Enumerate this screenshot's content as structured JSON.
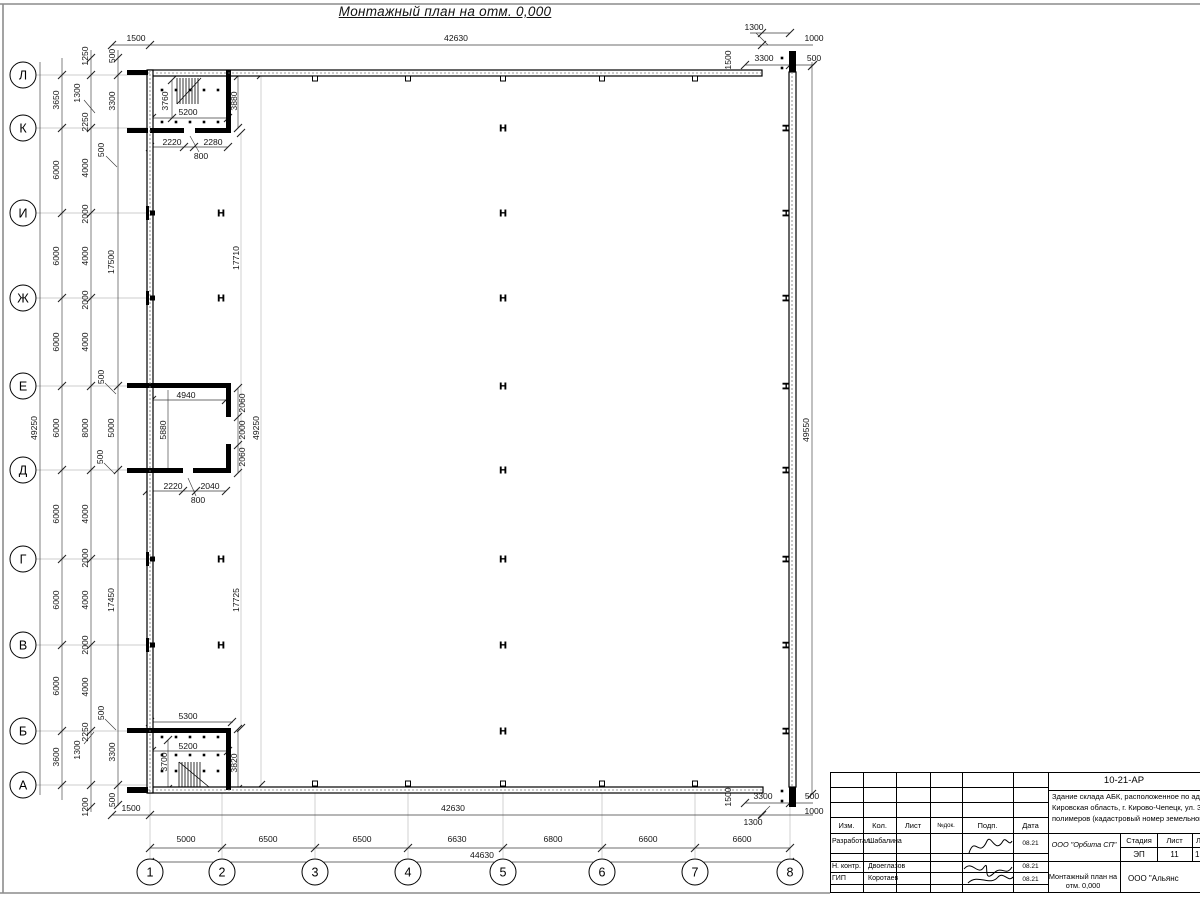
{
  "sheet": {
    "title": "Монтажный план на отм. 0,000"
  },
  "axes": {
    "rows": [
      {
        "l": "Л",
        "y": 75
      },
      {
        "l": "К",
        "y": 128
      },
      {
        "l": "И",
        "y": 213
      },
      {
        "l": "Ж",
        "y": 298
      },
      {
        "l": "Е",
        "y": 386
      },
      {
        "l": "Д",
        "y": 470
      },
      {
        "l": "Г",
        "y": 559
      },
      {
        "l": "В",
        "y": 645
      },
      {
        "l": "Б",
        "y": 731
      },
      {
        "l": "А",
        "y": 785
      }
    ],
    "cols": [
      {
        "l": "1",
        "x": 150
      },
      {
        "l": "2",
        "x": 222
      },
      {
        "l": "3",
        "x": 315
      },
      {
        "l": "4",
        "x": 408
      },
      {
        "l": "5",
        "x": 503
      },
      {
        "l": "6",
        "x": 602
      },
      {
        "l": "7",
        "x": 695
      },
      {
        "l": "8",
        "x": 790
      }
    ]
  },
  "title_block": {
    "doc_code": "10-21-АР",
    "desc1": "Здание склада АБК, расположенное по адресу: Российская Феде",
    "desc2": "Кировская область, г. Кирово-Чепецк, ул. Заводская, площадка з",
    "desc3": "полимеров (кадастровый номер земельного участка 43:42:0000",
    "header": {
      "izm": "Изм.",
      "kol": "Кол.",
      "list": "Лист",
      "ndok": "№док.",
      "podp": "Подп.",
      "data": "Дата"
    },
    "rows": {
      "r1": {
        "role": "Разработал",
        "name": "Шабалина",
        "date": "08.21"
      },
      "r2": {
        "role": "Н. контр.",
        "name": "Двоеглазов",
        "date": "08.21"
      },
      "r3": {
        "role": "ГИП",
        "name": "Коротаев",
        "date": "08.21"
      }
    },
    "org": "ООО \"Орбита СП\"",
    "stage_h": "Стадия",
    "sheet_h": "Лист",
    "sheets_h": "Листов",
    "stage": "ЭП",
    "sheet_no": "11",
    "sheets": "1",
    "drawing_name": "Монтажный план на отм. 0,000",
    "company": "ООО \"Альянс"
  },
  "drawing": {
    "frame": [
      [
        0,
        4,
        1200,
        4
      ],
      [
        0,
        893,
        830,
        893
      ],
      [
        3,
        4,
        3,
        893
      ]
    ],
    "lines_gray": [
      [
        36,
        75,
        147,
        75
      ],
      [
        36,
        128,
        147,
        128
      ],
      [
        36,
        213,
        147,
        213
      ],
      [
        36,
        298,
        147,
        298
      ],
      [
        36,
        386,
        147,
        386
      ],
      [
        36,
        470,
        147,
        470
      ],
      [
        36,
        559,
        147,
        559
      ],
      [
        36,
        645,
        147,
        645
      ],
      [
        36,
        731,
        147,
        731
      ],
      [
        36,
        785,
        147,
        785
      ],
      [
        150,
        793,
        150,
        858
      ],
      [
        222,
        793,
        222,
        858
      ],
      [
        315,
        793,
        315,
        858
      ],
      [
        408,
        793,
        408,
        858
      ],
      [
        503,
        793,
        503,
        858
      ],
      [
        602,
        793,
        602,
        858
      ],
      [
        695,
        793,
        695,
        858
      ],
      [
        790,
        793,
        790,
        858
      ],
      [
        241,
        133,
        241,
        728
      ],
      [
        261,
        75,
        261,
        785
      ]
    ],
    "lines_dim": [
      [
        40,
        62,
        40,
        795
      ],
      [
        62,
        58,
        62,
        800
      ],
      [
        91,
        50,
        91,
        812
      ],
      [
        118,
        50,
        118,
        806
      ],
      [
        812,
        62,
        812,
        795
      ],
      [
        112,
        45,
        813,
        45
      ],
      [
        745,
        65,
        813,
        65
      ],
      [
        750,
        33,
        790,
        33
      ],
      [
        112,
        815,
        813,
        815
      ],
      [
        150,
        848,
        790,
        848
      ],
      [
        150,
        862,
        790,
        862
      ],
      [
        745,
        803,
        813,
        803
      ],
      [
        152,
        118,
        228,
        118
      ],
      [
        172,
        80,
        172,
        118
      ],
      [
        238,
        76,
        238,
        128
      ],
      [
        150,
        147,
        228,
        147
      ],
      [
        152,
        400,
        226,
        400
      ],
      [
        168,
        390,
        168,
        468
      ],
      [
        238,
        388,
        238,
        473
      ],
      [
        147,
        491,
        226,
        491
      ],
      [
        150,
        722,
        233,
        722
      ],
      [
        152,
        751,
        228,
        751
      ],
      [
        168,
        740,
        168,
        789
      ],
      [
        238,
        729,
        238,
        789
      ],
      [
        756,
        33,
        768,
        45
      ],
      [
        84,
        100,
        95,
        113
      ],
      [
        84,
        744,
        94,
        732
      ],
      [
        106,
        156,
        117,
        167
      ],
      [
        105,
        383,
        116,
        394
      ],
      [
        104,
        463,
        115,
        474
      ],
      [
        105,
        719,
        116,
        730
      ],
      [
        190,
        136,
        199,
        152
      ],
      [
        188,
        478,
        196,
        496
      ],
      [
        758,
        818,
        770,
        806
      ]
    ],
    "ticks": [
      [
        150,
        848
      ],
      [
        222,
        848
      ],
      [
        315,
        848
      ],
      [
        408,
        848
      ],
      [
        503,
        848
      ],
      [
        602,
        848
      ],
      [
        695,
        848
      ],
      [
        790,
        848
      ],
      [
        62,
        75
      ],
      [
        62,
        128
      ],
      [
        62,
        213
      ],
      [
        62,
        298
      ],
      [
        62,
        386
      ],
      [
        62,
        470
      ],
      [
        62,
        559
      ],
      [
        62,
        645
      ],
      [
        62,
        731
      ],
      [
        62,
        785
      ],
      [
        91,
        58
      ],
      [
        91,
        75
      ],
      [
        91,
        128
      ],
      [
        91,
        213
      ],
      [
        91,
        298
      ],
      [
        91,
        386
      ],
      [
        91,
        470
      ],
      [
        91,
        559
      ],
      [
        91,
        645
      ],
      [
        91,
        731
      ],
      [
        91,
        785
      ],
      [
        91,
        807
      ],
      [
        118,
        58
      ],
      [
        118,
        75
      ],
      [
        118,
        386
      ],
      [
        118,
        470
      ],
      [
        118,
        785
      ],
      [
        118,
        805
      ],
      [
        112,
        45
      ],
      [
        150,
        45
      ],
      [
        762,
        45
      ],
      [
        762,
        33
      ],
      [
        790,
        33
      ],
      [
        745,
        65
      ],
      [
        790,
        65
      ],
      [
        813,
        65
      ],
      [
        112,
        815
      ],
      [
        150,
        815
      ],
      [
        762,
        815
      ],
      [
        745,
        803
      ],
      [
        790,
        803
      ],
      [
        150,
        862
      ],
      [
        790,
        862
      ],
      [
        812,
        66
      ],
      [
        812,
        794
      ],
      [
        261,
        75
      ],
      [
        261,
        785
      ],
      [
        241,
        133
      ],
      [
        241,
        728
      ],
      [
        150,
        147
      ],
      [
        184,
        147
      ],
      [
        194,
        147
      ],
      [
        228,
        147
      ],
      [
        152,
        118
      ],
      [
        228,
        118
      ],
      [
        172,
        80
      ],
      [
        172,
        118
      ],
      [
        238,
        76
      ],
      [
        238,
        128
      ],
      [
        152,
        400
      ],
      [
        226,
        400
      ],
      [
        147,
        491
      ],
      [
        183,
        491
      ],
      [
        196,
        491
      ],
      [
        226,
        491
      ],
      [
        238,
        388
      ],
      [
        238,
        417
      ],
      [
        238,
        445
      ],
      [
        238,
        473
      ],
      [
        150,
        722
      ],
      [
        232,
        722
      ],
      [
        152,
        751
      ],
      [
        228,
        751
      ],
      [
        168,
        740
      ],
      [
        168,
        789
      ],
      [
        238,
        729
      ],
      [
        238,
        789
      ]
    ],
    "walls_outline": [
      [
        148,
        70,
        614,
        6
      ],
      [
        148,
        787,
        615,
        6
      ],
      [
        147,
        70,
        6,
        723
      ],
      [
        789,
        72,
        7,
        715
      ]
    ],
    "wall_mid_dash": [
      [
        148,
        73,
        762,
        73
      ],
      [
        148,
        790,
        763,
        790
      ],
      [
        150,
        70,
        150,
        793
      ],
      [
        792,
        72,
        792,
        787
      ]
    ],
    "walls_solid": [
      [
        127,
        70,
        21,
        5
      ],
      [
        127,
        128,
        21,
        5
      ],
      [
        127,
        383,
        21,
        5
      ],
      [
        127,
        468,
        21,
        5
      ],
      [
        127,
        728,
        21,
        5
      ],
      [
        127,
        787,
        21,
        6
      ],
      [
        226,
        70,
        5,
        63
      ],
      [
        150,
        128,
        34,
        5
      ],
      [
        195,
        128,
        33,
        5
      ],
      [
        148,
        383,
        83,
        5
      ],
      [
        226,
        388,
        5,
        29
      ],
      [
        226,
        444,
        5,
        29
      ],
      [
        147,
        468,
        36,
        5
      ],
      [
        193,
        468,
        38,
        5
      ],
      [
        147,
        728,
        84,
        5
      ],
      [
        226,
        728,
        5,
        62
      ],
      [
        789,
        51,
        7,
        21
      ],
      [
        789,
        787,
        7,
        20
      ]
    ],
    "tabs": {
      "top_y": 76,
      "bot_y": 781,
      "xs": [
        315,
        408,
        503,
        602,
        695
      ]
    },
    "hcols_plain": [
      [
        503,
        [
          128,
          213,
          298,
          386,
          470,
          559,
          645,
          731
        ]
      ],
      [
        221,
        [
          213,
          298,
          559,
          645
        ]
      ]
    ],
    "hcols_rot": {
      "x": 786,
      "ys": [
        128,
        213,
        298,
        386,
        470,
        559,
        645,
        731
      ]
    },
    "pilasters": [
      213,
      298,
      559,
      645
    ],
    "dots": [
      [
        162,
        90
      ],
      [
        176,
        90
      ],
      [
        190,
        90
      ],
      [
        204,
        90
      ],
      [
        218,
        90
      ],
      [
        162,
        122
      ],
      [
        176,
        122
      ],
      [
        190,
        122
      ],
      [
        204,
        122
      ],
      [
        218,
        122
      ],
      [
        162,
        737
      ],
      [
        176,
        737
      ],
      [
        190,
        737
      ],
      [
        204,
        737
      ],
      [
        218,
        737
      ],
      [
        162,
        755
      ],
      [
        176,
        755
      ],
      [
        190,
        755
      ],
      [
        204,
        755
      ],
      [
        218,
        755
      ],
      [
        162,
        771
      ],
      [
        176,
        771
      ],
      [
        204,
        771
      ],
      [
        218,
        771
      ],
      [
        782,
        58
      ],
      [
        782,
        68
      ],
      [
        782,
        791
      ],
      [
        782,
        801
      ]
    ],
    "stairs": [
      {
        "x": 177,
        "y": 78,
        "h": 26,
        "n": 8,
        "dir": 1
      },
      {
        "x": 179,
        "y": 762,
        "h": 25,
        "n": 8,
        "dir": 0
      }
    ],
    "labels": [
      [
        "1500",
        136,
        38,
        0
      ],
      [
        "42630",
        456,
        38,
        0
      ],
      [
        "1300",
        754,
        27,
        0
      ],
      [
        "1000",
        814,
        38,
        0
      ],
      [
        "3300",
        764,
        58,
        0
      ],
      [
        "500",
        814,
        58,
        0
      ],
      [
        "1500",
        728,
        60,
        1
      ],
      [
        "49250",
        34,
        428,
        1
      ],
      [
        "3650",
        56,
        100,
        1
      ],
      [
        "6000",
        56,
        170,
        1
      ],
      [
        "6000",
        56,
        256,
        1
      ],
      [
        "6000",
        56,
        342,
        1
      ],
      [
        "6000",
        56,
        428,
        1
      ],
      [
        "6000",
        56,
        514,
        1
      ],
      [
        "6000",
        56,
        600,
        1
      ],
      [
        "6000",
        56,
        686,
        1
      ],
      [
        "3600",
        56,
        757,
        1
      ],
      [
        "1250",
        85,
        56,
        1
      ],
      [
        "2250",
        85,
        122,
        1
      ],
      [
        "4000",
        85,
        168,
        1
      ],
      [
        "2000",
        85,
        214,
        1
      ],
      [
        "4000",
        85,
        256,
        1
      ],
      [
        "2000",
        85,
        300,
        1
      ],
      [
        "4000",
        85,
        342,
        1
      ],
      [
        "8000",
        85,
        428,
        1
      ],
      [
        "4000",
        85,
        514,
        1
      ],
      [
        "2000",
        85,
        558,
        1
      ],
      [
        "4000",
        85,
        600,
        1
      ],
      [
        "2000",
        85,
        645,
        1
      ],
      [
        "4000",
        85,
        687,
        1
      ],
      [
        "2250",
        85,
        732,
        1
      ],
      [
        "1200",
        85,
        807,
        1
      ],
      [
        "1300",
        77,
        93,
        1
      ],
      [
        "1300",
        77,
        750,
        1
      ],
      [
        "500",
        112,
        56,
        1
      ],
      [
        "3300",
        112,
        101,
        1
      ],
      [
        "17500",
        111,
        262,
        1
      ],
      [
        "5000",
        111,
        428,
        1
      ],
      [
        "17450",
        111,
        600,
        1
      ],
      [
        "3300",
        112,
        752,
        1
      ],
      [
        "500",
        112,
        800,
        1
      ],
      [
        "500",
        101,
        150,
        1
      ],
      [
        "500",
        101,
        377,
        1
      ],
      [
        "500",
        100,
        457,
        1
      ],
      [
        "500",
        101,
        713,
        1
      ],
      [
        "17710",
        236,
        258,
        1
      ],
      [
        "17725",
        236,
        600,
        1
      ],
      [
        "49250",
        256,
        428,
        1
      ],
      [
        "49550",
        806,
        430,
        1
      ],
      [
        "3760",
        165,
        101,
        1
      ],
      [
        "5200",
        188,
        112,
        0
      ],
      [
        "3880",
        234,
        101,
        1
      ],
      [
        "2220",
        172,
        142,
        0
      ],
      [
        "2280",
        213,
        142,
        0
      ],
      [
        "800",
        201,
        156,
        0
      ],
      [
        "4940",
        186,
        395,
        0
      ],
      [
        "5880",
        163,
        430,
        1
      ],
      [
        "2060",
        242,
        403,
        1
      ],
      [
        "2000",
        242,
        430,
        1
      ],
      [
        "2060",
        242,
        457,
        1
      ],
      [
        "2220",
        173,
        486,
        0
      ],
      [
        "2040",
        210,
        486,
        0
      ],
      [
        "800",
        198,
        500,
        0
      ],
      [
        "5300",
        188,
        716,
        0
      ],
      [
        "5200",
        188,
        746,
        0
      ],
      [
        "3700",
        164,
        762,
        1
      ],
      [
        "3820",
        234,
        763,
        1
      ],
      [
        "1500",
        728,
        797,
        1
      ],
      [
        "3300",
        763,
        796,
        0
      ],
      [
        "500",
        812,
        796,
        0
      ],
      [
        "1000",
        814,
        811,
        0
      ],
      [
        "1300",
        753,
        822,
        0
      ],
      [
        "1500",
        131,
        808,
        0
      ],
      [
        "42630",
        453,
        808,
        0
      ],
      [
        "5000",
        186,
        839,
        0
      ],
      [
        "6500",
        268,
        839,
        0
      ],
      [
        "6500",
        362,
        839,
        0
      ],
      [
        "6630",
        457,
        839,
        0
      ],
      [
        "6800",
        553,
        839,
        0
      ],
      [
        "6600",
        648,
        839,
        0
      ],
      [
        "6600",
        742,
        839,
        0
      ],
      [
        "44630",
        482,
        855,
        0
      ]
    ]
  }
}
